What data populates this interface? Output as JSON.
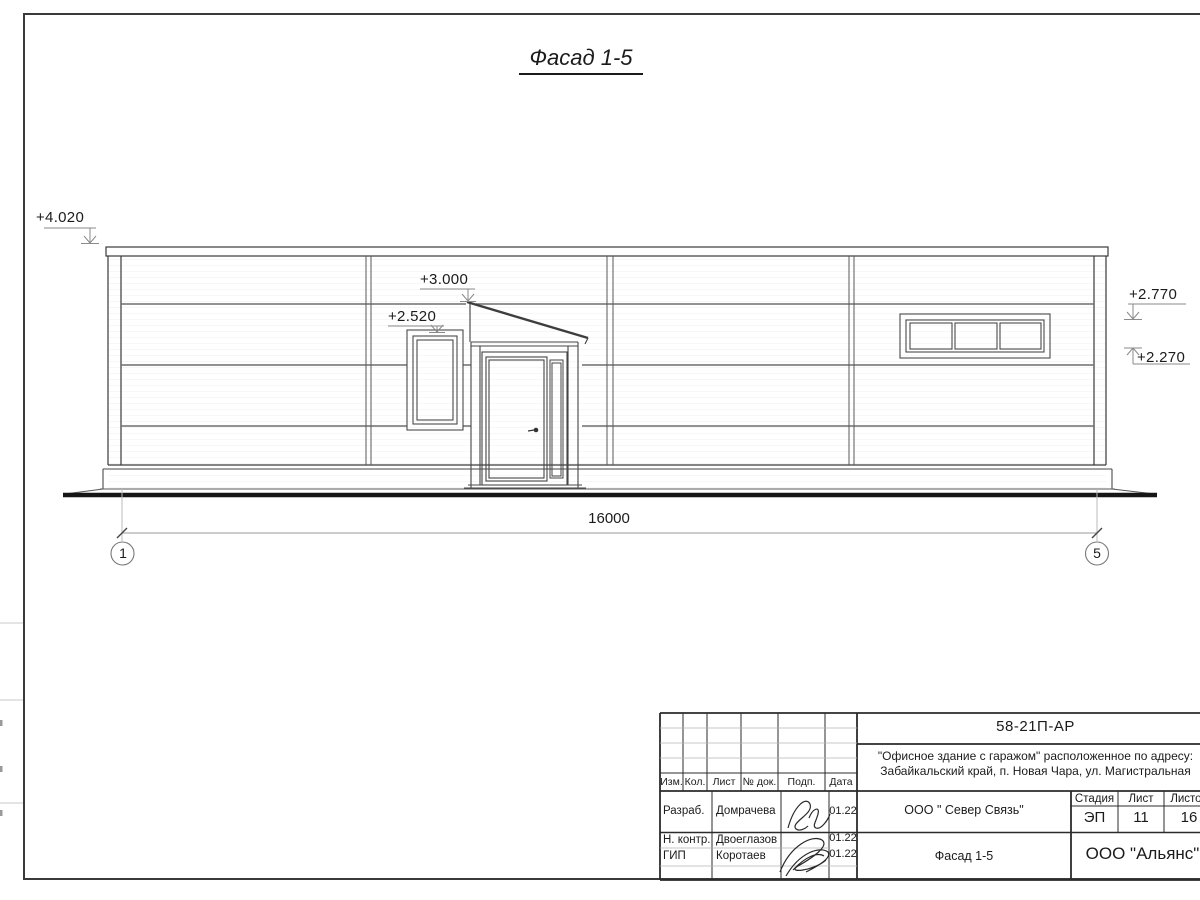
{
  "colors": {
    "ink": "#2e2e2e",
    "joint": "#6f6f6f",
    "leader": "#9a9a9a"
  },
  "drawing": {
    "title": "Фасад 1-5",
    "marks": {
      "top": "+4.020",
      "canopy": "+3.000",
      "window": "+2.520",
      "right_upper": "+2.770",
      "right_lower": "+2.270"
    },
    "dim_total": "16000",
    "axes": {
      "left": "1",
      "right": "5"
    }
  },
  "title_block": {
    "doc_number": "58-21П-АР",
    "project_line1": "\"Офисное здание с гаражом\" расположенное по адресу:",
    "project_line2": "Забайкальский край, п. Новая Чара, ул. Магистральная",
    "columns": {
      "izm": "Изм.",
      "kol": "Кол.",
      "list": "Лист",
      "dok": "№ док.",
      "podp": "Подп.",
      "data": "Дата"
    },
    "rows": [
      {
        "role": "Разраб.",
        "name": "Домрачева",
        "date": "01.22"
      },
      {
        "role": "Н. контр.",
        "name": "Двоеглазов",
        "date": "01.22"
      },
      {
        "role": "ГИП",
        "name": "Коротаев",
        "date": "01.22"
      }
    ],
    "org": "ООО \" Север Связь\"",
    "sheet_title": "Фасад 1-5",
    "company": "ООО \"Альянс\"",
    "stage": {
      "label": "Стадия",
      "value": "ЭП"
    },
    "sheet": {
      "label": "Лист",
      "value": "11"
    },
    "sheets": {
      "label": "Листов",
      "value": "16"
    }
  }
}
